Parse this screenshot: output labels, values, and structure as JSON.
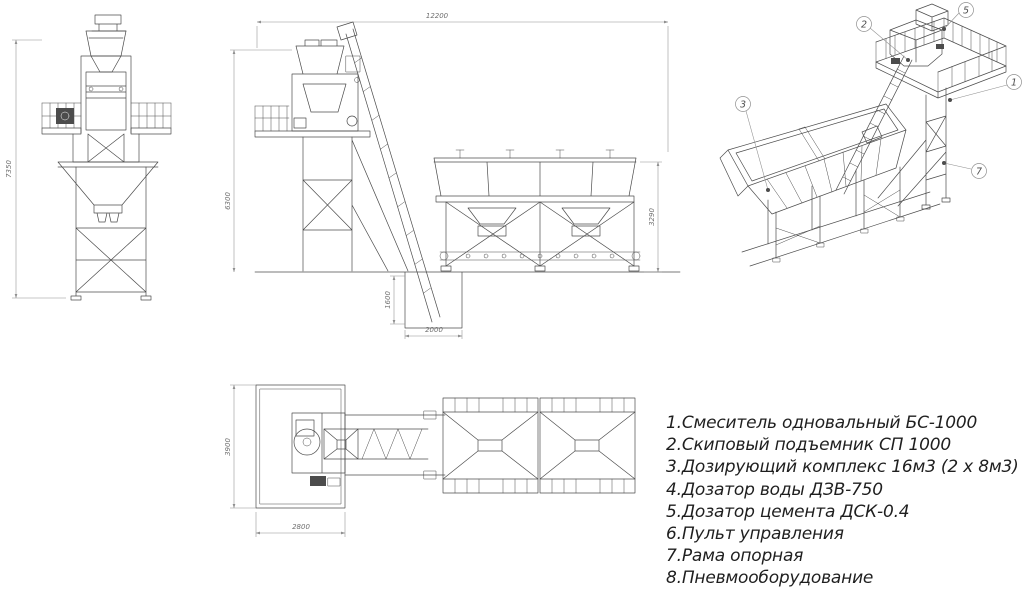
{
  "colors": {
    "background": "#ffffff",
    "line": "#4c4c4c",
    "dim_line": "#8f8f8f",
    "dim_text": "#6f6f6f",
    "text": "#1f1f1f"
  },
  "dimensions": {
    "front_overall_height": "7350",
    "side_overall_length": "12200",
    "side_mixer_height": "6300",
    "side_bins_height": "3290",
    "side_pit_depth": "1600",
    "side_pit_length": "2000",
    "plan_overall_width": "3900",
    "plan_platform_length": "2800"
  },
  "callouts": [
    {
      "num": "1"
    },
    {
      "num": "2"
    },
    {
      "num": "3"
    },
    {
      "num": "5"
    },
    {
      "num": "7"
    }
  ],
  "parts_list": [
    {
      "text": "1.Смеситель одновальный БС-1000"
    },
    {
      "text": "2.Скиповый подъемник СП 1000"
    },
    {
      "text": "3.Дозирующий комплекс 16м3 (2 х 8м3)"
    },
    {
      "text": "4.Дозатор воды ДЗВ-750"
    },
    {
      "text": "5.Дозатор цемента ДСК-0.4"
    },
    {
      "text": "6.Пульт управления"
    },
    {
      "text": "7.Рама опорная"
    },
    {
      "text": "8.Пневмооборудование"
    }
  ]
}
